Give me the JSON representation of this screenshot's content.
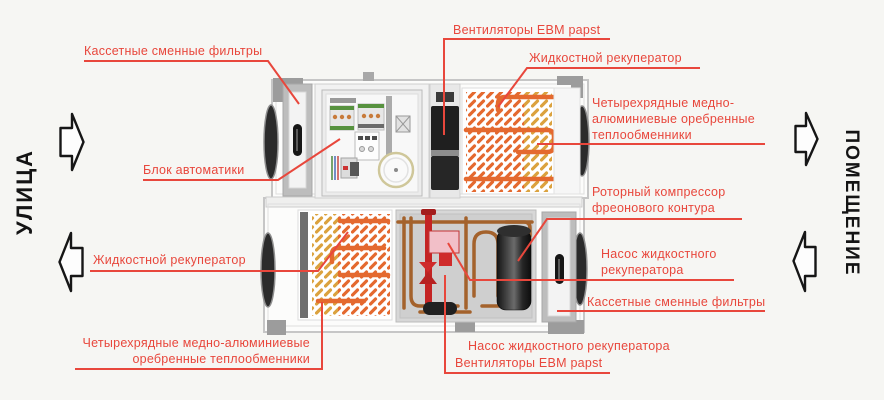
{
  "diagram_title": "Схема приточно-вытяжной установки",
  "sides": {
    "left": "УЛИЦА",
    "right": "ПОМЕЩЕНИЕ"
  },
  "labels": {
    "filters_supply": "Кассетные сменные фильтры",
    "fans_supply": "Вентиляторы EBM papst",
    "liquid_recuperator_supply": "Жидкостной рекуператор",
    "heat_exchangers_supply": "Четырехрядные медно-\nалюминиевые оребренные\nтеплообменники",
    "automation_unit": "Блок автоматики",
    "rotary_compressor": "Роторный компрессор\nфреонового контура",
    "recuperator_pump_right": "Насос жидкостного\nрекуператора",
    "filters_exhaust": "Кассетные сменные фильтры",
    "liquid_recuperator_exhaust": "Жидкостной рекуператор",
    "heat_exchangers_exhaust": "Четырехрядные медно-алюминиевые\nоребренные теплообменники",
    "recuperator_pump_bottom": "Насос жидкостного рекуператора",
    "fans_exhaust": "Вентиляторы EBM papst"
  },
  "colors": {
    "label_red": "#e8473c",
    "side_text": "#141414",
    "pipe_orange": "#e4692f",
    "coil_yellow": "#dba23e",
    "copper": "#a4622c",
    "pump_red": "#cf2b2b",
    "casing_gray": "#c6c6c6"
  }
}
